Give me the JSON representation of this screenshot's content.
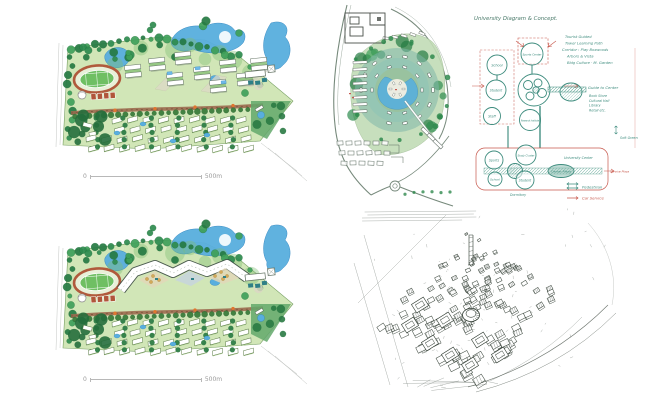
{
  "colors": {
    "water": "#58aede",
    "tree_green": "#2e8b4f",
    "field_green": "#cfe5b4",
    "track_brown": "#b05a3c",
    "road_brown": "#9b6a4f",
    "ink_teal": "#3e8c7e",
    "ink_red": "#c7584c",
    "sketch_ink": "#2f3b31",
    "accent_orange": "#e0762f"
  },
  "site_plan_a": {
    "scale_start": "0",
    "scale_end": "500m"
  },
  "site_plan_b": {
    "scale_start": "0",
    "scale_end": "500m"
  },
  "concept_diagram": {
    "title": "University Diagram & Concept.",
    "notes": [
      "Tourist Guided",
      "Tower Learning Path",
      "Corridor : Play Boxwoods",
      "Arbors & Vista",
      "Bldg Culture · M. Garden"
    ],
    "upper": {
      "school": "School",
      "sports_center": "Sports Center",
      "student": "Student",
      "staff": "Staff",
      "institute": "Research Institute",
      "guide": "Guide to Center",
      "guide_list": [
        "Book Store",
        "Cultural Hall",
        "Library",
        "Retail etc."
      ],
      "soft_green": "Soft Green"
    },
    "lower": {
      "sports": "Sports",
      "study_cluster": "Study Cluster",
      "university_center": "University Center",
      "center_plaza": "Center Plaza",
      "school": "School",
      "student": "Student",
      "dormitory": "Dormitory",
      "service_plaza": "Service Plaza"
    },
    "legend": {
      "pedestrian": "Pedestrian",
      "car_service": "Car Service"
    }
  }
}
